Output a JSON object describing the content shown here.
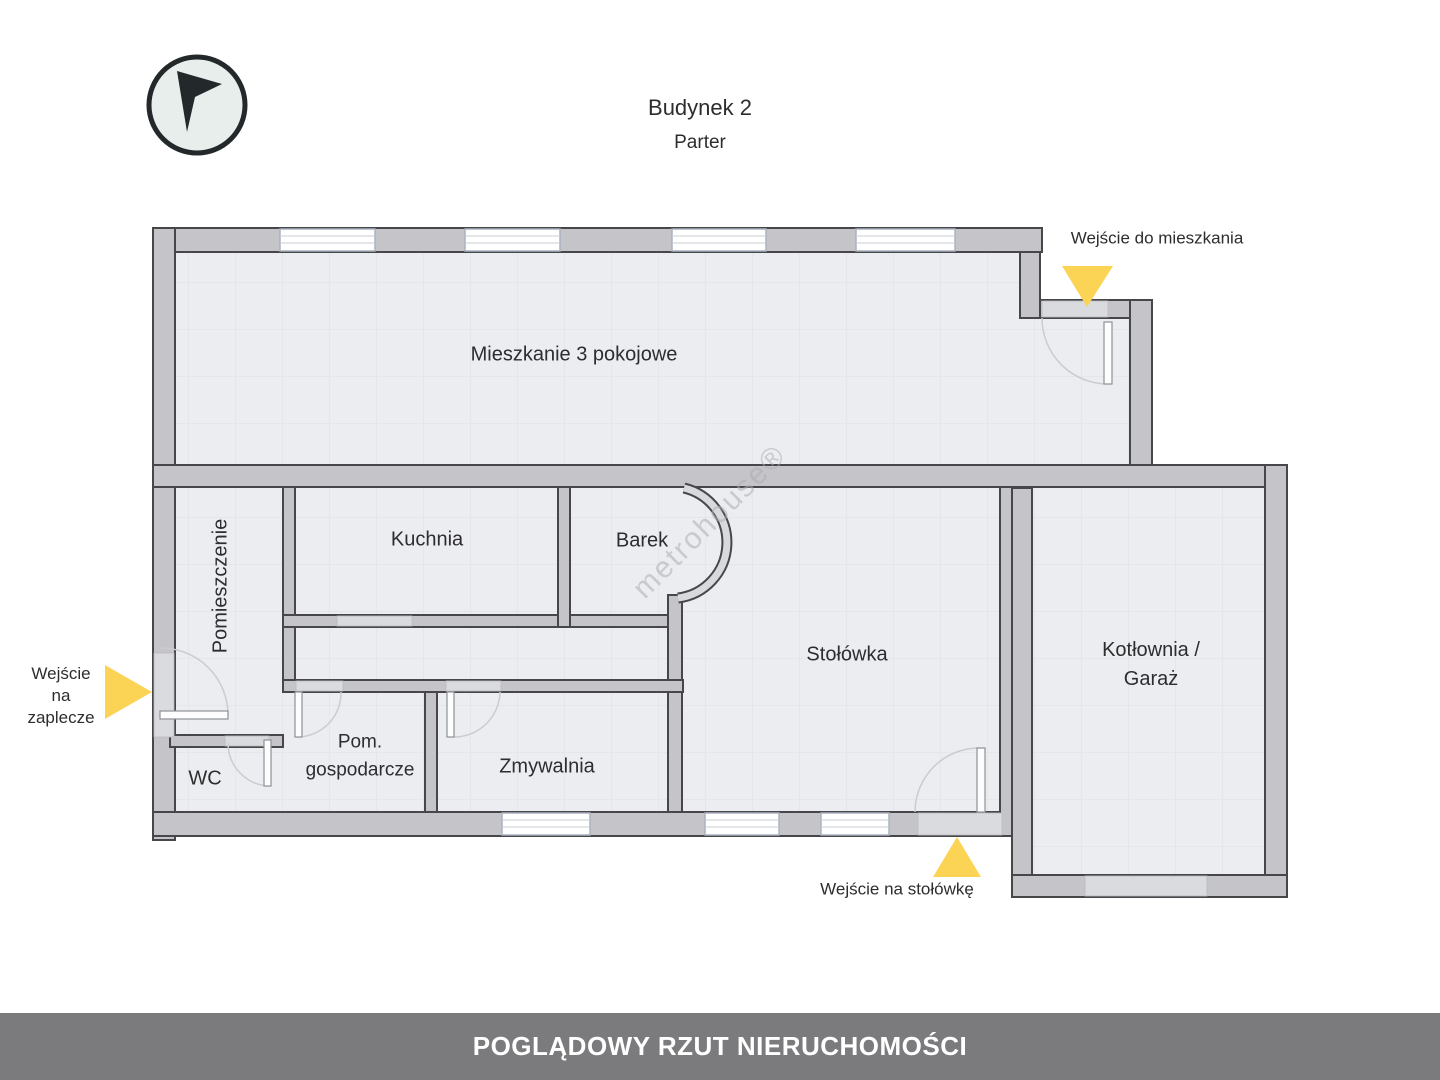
{
  "header": {
    "building": "Budynek 2",
    "floor": "Parter"
  },
  "compass": {
    "icon": "north-arrow-icon"
  },
  "watermark": {
    "text": "metrohouse®"
  },
  "rooms": {
    "mieszkanie": "Mieszkanie 3 pokojowe",
    "pomieszczenie": "Pomieszczenie",
    "kuchnia": "Kuchnia",
    "barek": "Barek",
    "stolowka": "Stołówka",
    "kotlownia_line1": "Kotłownia /",
    "kotlownia_line2": "Garaż",
    "wc": "WC",
    "pom_gosp_line1": "Pom.",
    "pom_gosp_line2": "gospodarcze",
    "zmywalnia": "Zmywalnia"
  },
  "entrances": {
    "mieszkanie": "Wejście do mieszkania",
    "zaplecze_line1": "Wejście",
    "zaplecze_line2": "na",
    "zaplecze_line3": "zaplecze",
    "stolowka": "Wejście na stołówkę"
  },
  "footer": {
    "title": "POGLĄDOWY RZUT NIERUCHOMOŚCI"
  },
  "colors": {
    "accent_yellow": "#fbd456",
    "wall_fill": "#c5c5c9",
    "wall_outline": "#47474a",
    "opening_fill": "#dadbdf",
    "floor": "#ecedf0",
    "grid_line": "#e2e4e8",
    "footer_bg": "#7b7b7d",
    "text": "#2d2d2f"
  }
}
